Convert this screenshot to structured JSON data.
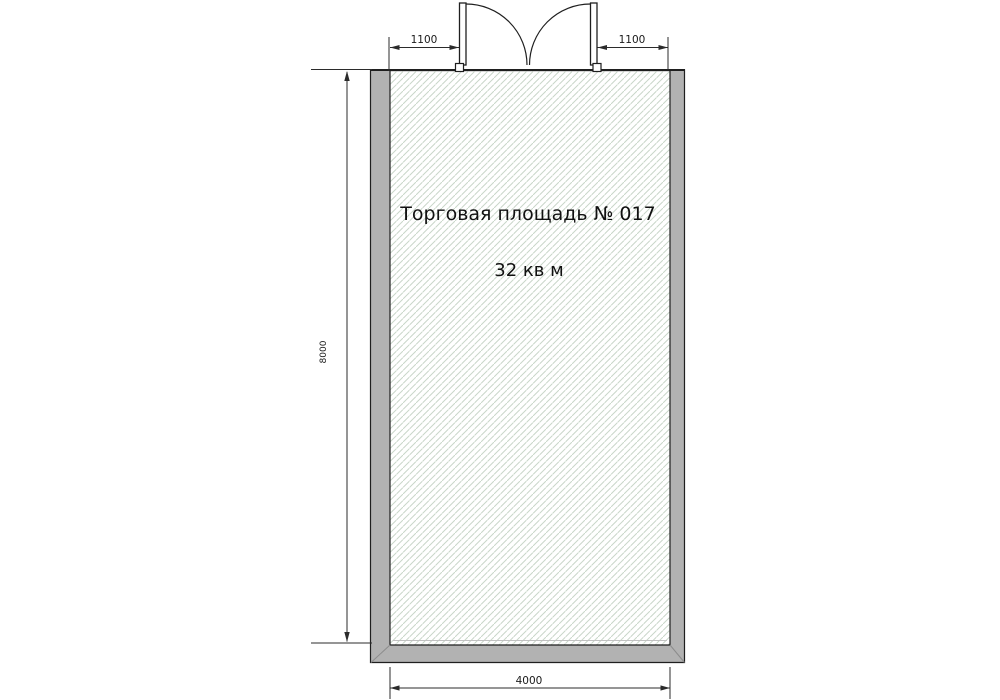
{
  "plan": {
    "room": {
      "label": "Торговая площадь № 017",
      "area": "32 кв м"
    },
    "dimensions": {
      "door_left_mm": "1100",
      "door_right_mm": "1100",
      "interior_height_mm": "8000",
      "interior_width_mm": "4000"
    },
    "colors": {
      "background": "#ffffff",
      "wall_fill": "#b2b2b2",
      "outline": "#1f1f1f",
      "dimension_line": "#2b2b2b",
      "hatch_line": "#c9d6c9"
    }
  }
}
